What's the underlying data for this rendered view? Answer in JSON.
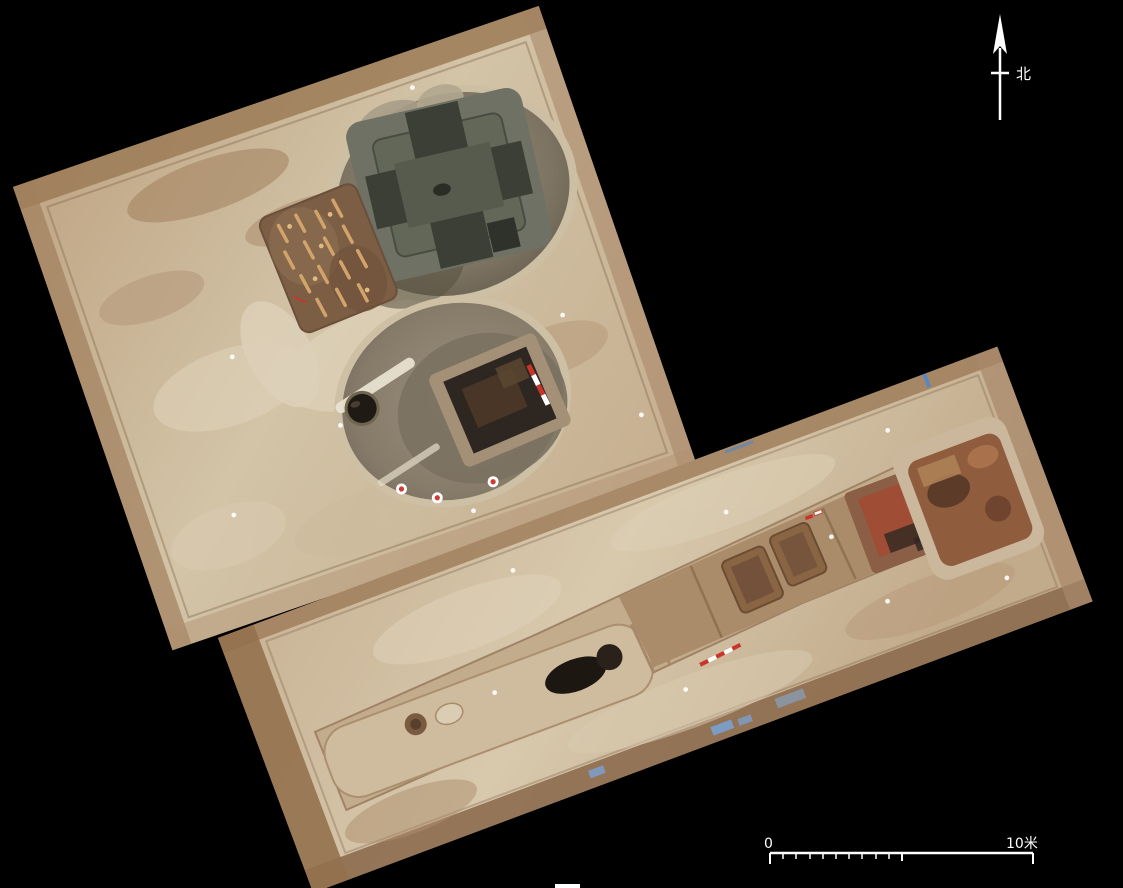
{
  "figure": {
    "description": "Aerial orthophoto mosaic of an excavated tomb complex: two rotated photo tiles on a black background. Upper tile holds a pit with a cruciform stone sarcophagus, a ramp lined with figurines and a deep chamber pit with a dark coffin chamber and pot. Lower tile holds a long sloped passage with stepped ramp, two niches, a painted mural panel and a red-brown side chamber.",
    "background_color": "#000000"
  },
  "north_arrow": {
    "label": "北"
  },
  "scale_bar": {
    "zero_label": "0",
    "max_label": "10米"
  },
  "colors": {
    "annotation_white": "#ffffff",
    "ground_tan": "#c8b294",
    "ground_light": "#dccfb6",
    "soil_border_brown": "#96744f",
    "pit_wall_gray": "#8b8070",
    "stone_structure_gray_green": "#6e7163",
    "stone_recess_dark": "#3b3f35",
    "figurine_platform_brown": "#7c5e45",
    "figurine_ochre": "#d2a46c",
    "burial_chamber_dark": "#2e2620",
    "mural_red": "#a34a34",
    "passage_brown": "#ab8c6a",
    "side_chamber_red_brown": "#8f5c3e",
    "tarp_blue": "#7d9cc4",
    "survey_marker_red": "#d03a30"
  }
}
